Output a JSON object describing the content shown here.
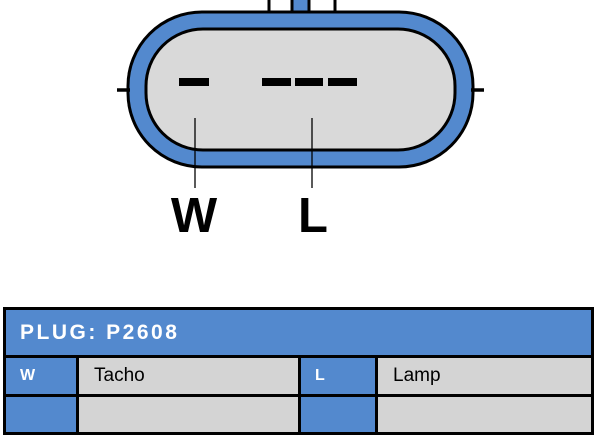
{
  "colors": {
    "accent_blue": "#5389CE",
    "connector_fill_gray": "#D9D9D9",
    "table_cell_gray": "#D4D4D4",
    "outline_black": "#000000"
  },
  "connector": {
    "description": "2-pin plug face view with latch tab on top",
    "labels": {
      "w": "W",
      "l": "L"
    }
  },
  "plug_table": {
    "title": "PLUG: P2608",
    "rows": [
      {
        "pin_left": "W",
        "desc_left": "Tacho",
        "pin_right": "L",
        "desc_right": "Lamp"
      },
      {
        "pin_left": "",
        "desc_left": "",
        "pin_right": "",
        "desc_right": ""
      }
    ]
  }
}
